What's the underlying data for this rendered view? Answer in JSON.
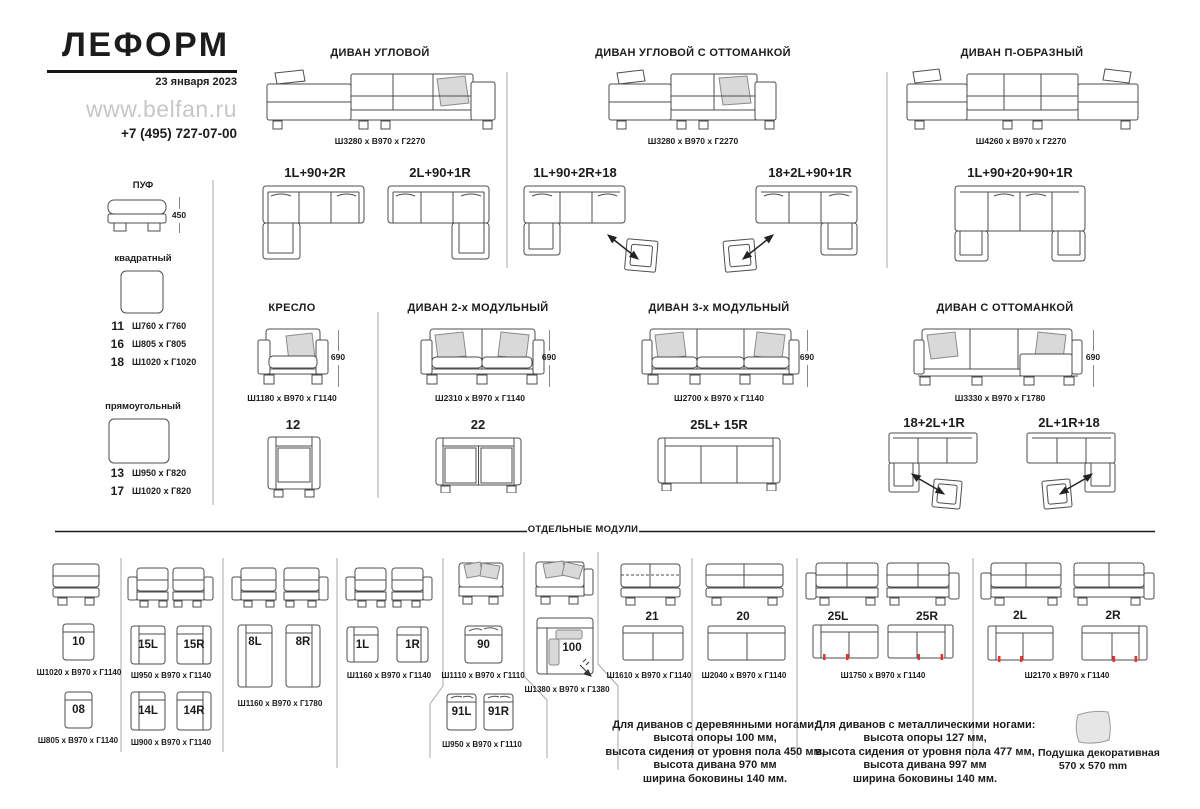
{
  "colors": {
    "line": "#4d4d4d",
    "pillow_fill": "#d9d9d9",
    "divider": "#a8a8a8",
    "accent_red": "#e8352b",
    "muted_gray": "#c7c7c7"
  },
  "header": {
    "brand": "ЛЕФОРМ",
    "date": "23 января 2023",
    "website": "www.belfan.ru",
    "phone": "+7 (495) 727-07-00"
  },
  "pouf": {
    "title": "ПУФ",
    "height": "450",
    "square_label": "квадратный",
    "square_items": [
      {
        "num": "11",
        "dims": "Ш760 х Г760"
      },
      {
        "num": "16",
        "dims": "Ш805 х Г805"
      },
      {
        "num": "18",
        "dims": "Ш1020 х Г1020"
      }
    ],
    "rect_label": "прямоугольный",
    "rect_items": [
      {
        "num": "13",
        "dims": "Ш950 х Г820"
      },
      {
        "num": "17",
        "dims": "Ш1020 х Г820"
      }
    ]
  },
  "sections": {
    "corner": {
      "title": "ДИВАН УГЛОВОЙ",
      "dims": "Ш3280 х В970 х Г2270",
      "config1": "1L+90+2R",
      "config2": "2L+90+1R"
    },
    "corner_ottoman": {
      "title": "ДИВАН УГЛОВОЙ С ОТТОМАНКОЙ",
      "dims": "Ш3280 х В970 х Г2270",
      "config1": "1L+90+2R+18",
      "config2": "18+2L+90+1R"
    },
    "u_shape": {
      "title": "ДИВАН П-ОБРАЗНЫЙ",
      "dims": "Ш4260 х В970 х Г2270",
      "config1": "1L+90+20+90+1R"
    },
    "armchair": {
      "title": "КРЕСЛО",
      "dims": "Ш1180 х В970 х Г1140",
      "height": "690",
      "config1": "12"
    },
    "sofa2": {
      "title": "ДИВАН 2-х МОДУЛЬНЫЙ",
      "dims": "Ш2310 х В970 х Г1140",
      "height": "690",
      "config1": "22"
    },
    "sofa3": {
      "title": "ДИВАН 3-х МОДУЛЬНЫЙ",
      "dims": "Ш2700 х В970 х Г1140",
      "height": "690",
      "config1": "25L+ 15R"
    },
    "sofa_ottoman": {
      "title": "ДИВАН С ОТТОМАНКОЙ",
      "dims": "Ш3330 х В970 х Г1780",
      "height": "690",
      "config1": "18+2L+1R",
      "config2": "2L+1R+18"
    }
  },
  "modules": {
    "title": "ОТДЕЛЬНЫЕ МОДУЛИ",
    "m10": {
      "label": "10",
      "dims": "Ш1020 х В970 х Г1140"
    },
    "m08": {
      "label": "08",
      "dims": "Ш805 х В970 х Г1140"
    },
    "m15": {
      "labelL": "15L",
      "labelR": "15R",
      "dims": "Ш950 х В970 х Г1140"
    },
    "m14": {
      "labelL": "14L",
      "labelR": "14R",
      "dims": "Ш900 х В970 х Г1140"
    },
    "m8": {
      "labelL": "8L",
      "labelR": "8R",
      "dims": "Ш1160 х В970 х Г1780"
    },
    "m1": {
      "labelL": "1L",
      "labelR": "1R",
      "dims": "Ш1160 х В970 х Г1140"
    },
    "m90": {
      "label": "90",
      "dims": "Ш1110 х В970 х Г1110"
    },
    "m91": {
      "labelL": "91L",
      "labelR": "91R",
      "dims": "Ш950 х В970 х Г1110"
    },
    "m100": {
      "label": "100",
      "dims": "Ш1380 х В970 х Г1380"
    },
    "m21": {
      "label": "21",
      "dims": "Ш1610 х В970 х Г1140"
    },
    "m20": {
      "label": "20",
      "dims": "Ш2040 х В970 х Г1140"
    },
    "m25": {
      "labelL": "25L",
      "labelR": "25R",
      "dims": "Ш1750 х В970 х Г1140"
    },
    "m2": {
      "labelL": "2L",
      "labelR": "2R",
      "dims": "Ш2170 х В970 х Г1140"
    }
  },
  "notes": {
    "wooden": {
      "l1": "Для диванов с деревянными ногами:",
      "l2": "высота опоры 100 мм,",
      "l3": "высота сидения от уровня пола 450 мм,",
      "l4": "высота дивана 970 мм",
      "l5": "ширина боковины 140 мм."
    },
    "metal": {
      "l1": "Для диванов с металлическими ногами:",
      "l2": "высота опоры 127 мм,",
      "l3": "высота сидения от уровня пола 477 мм,",
      "l4": "высота дивана 997 мм",
      "l5": "ширина боковины 140 мм."
    },
    "pillow": {
      "l1": "Подушка декоративная",
      "l2": "570 х 570 mm"
    }
  }
}
